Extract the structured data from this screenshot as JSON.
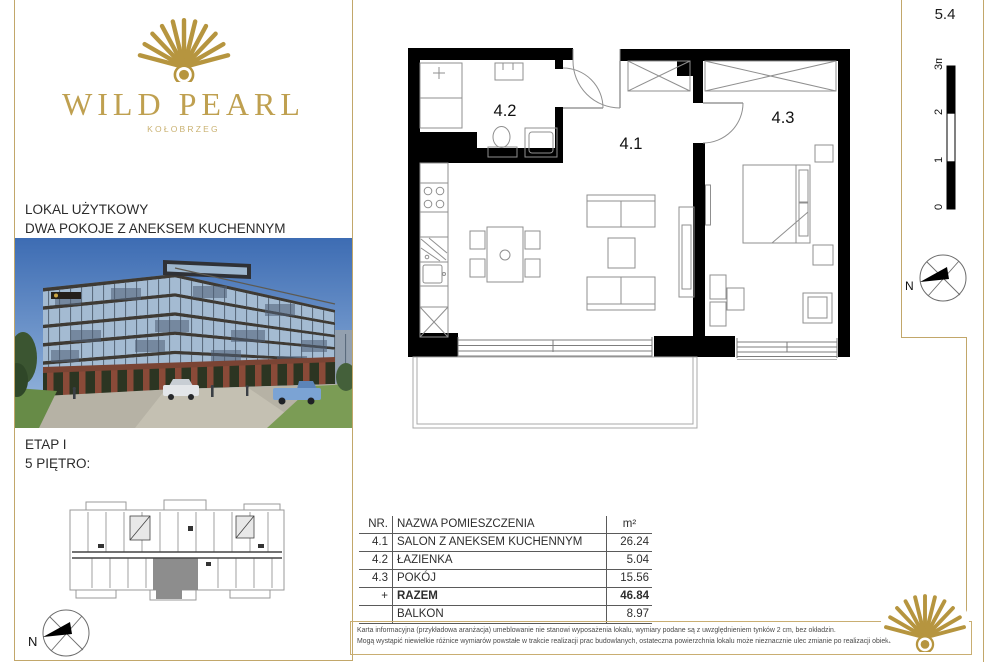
{
  "brand": {
    "name": "WILD PEARL",
    "city": "KOŁOBRZEG"
  },
  "unit_label": "5.4",
  "left_panel": {
    "heading_line1": "LOKAL UŻYTKOWY",
    "heading_line2": "DWA POKOJE Z ANEKSEM KUCHENNYM",
    "etap": "ETAP I",
    "floor": "5 PIĘTRO:"
  },
  "floor_plan": {
    "rooms": [
      {
        "id": "4.1"
      },
      {
        "id": "4.2"
      },
      {
        "id": "4.3"
      }
    ]
  },
  "scale_bar": {
    "labels": [
      "0",
      "1",
      "2",
      "3m"
    ]
  },
  "compass": {
    "label": "N"
  },
  "area_table": {
    "headers": {
      "nr": "NR.",
      "name": "NAZWA POMIESZCZENIA",
      "area": "m²"
    },
    "rows": [
      {
        "nr": "4.1",
        "name": "SALON Z ANEKSEM KUCHENNYM",
        "area": "26.24"
      },
      {
        "nr": "4.2",
        "name": "ŁAZIENKA",
        "area": "5.04"
      },
      {
        "nr": "4.3",
        "name": "POKÓJ",
        "area": "15.56"
      },
      {
        "nr": "+",
        "name": "RAZEM",
        "area": "46.84"
      },
      {
        "nr": "",
        "name": "BALKON",
        "area": "8.97"
      }
    ]
  },
  "disclaimer": {
    "line1": "Karta informacyjna (przykładowa aranżacja) umeblowanie nie stanowi wyposażenia lokalu, wymiary podane są z uwzględnieniem tynków 2 cm, bez okładzin.",
    "line2": "Mogą wystąpić niewielkie różnice wymiarów powstałe w trakcie realizacji prac budowlanych, ostateczna powierzchnia lokalu może nieznacznie ulec zmianie po realizacji obiektu."
  },
  "colors": {
    "gold": "#c2a76a",
    "gold_dark": "#b6953f",
    "ink": "#222222",
    "wall_black": "#000000",
    "highlight_gray": "#8d8d8d"
  }
}
